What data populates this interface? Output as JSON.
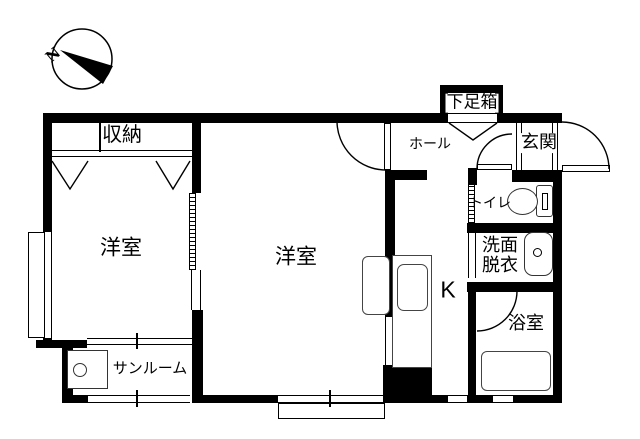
{
  "colors": {
    "line": "#000000",
    "background": "#ffffff"
  },
  "compass": {
    "north_label": "N"
  },
  "rooms": {
    "closet": {
      "label": "収納"
    },
    "bedroom_left": {
      "label": "洋室"
    },
    "bedroom_center": {
      "label": "洋室"
    },
    "sunroom": {
      "label": "サンルーム"
    },
    "hall": {
      "label": "ホール"
    },
    "shoe_box": {
      "label": "下足箱"
    },
    "entrance": {
      "label": "玄関"
    },
    "toilet": {
      "label": "トイレ"
    },
    "washroom": {
      "label_line1": "洗面",
      "label_line2": "脱衣"
    },
    "bathroom": {
      "label": "浴室"
    },
    "kitchen": {
      "label": "K"
    }
  },
  "icons": {
    "compass": "compass-north-arrow",
    "washing_machine": "square-with-circle",
    "refrigerator": "rounded-rectangle",
    "kitchen_sink": "sink-in-counter",
    "toilet": "toilet-bowl-with-tank",
    "washbasin": "basin-with-faucet",
    "bathtub": "rounded-rectangle-tub"
  }
}
